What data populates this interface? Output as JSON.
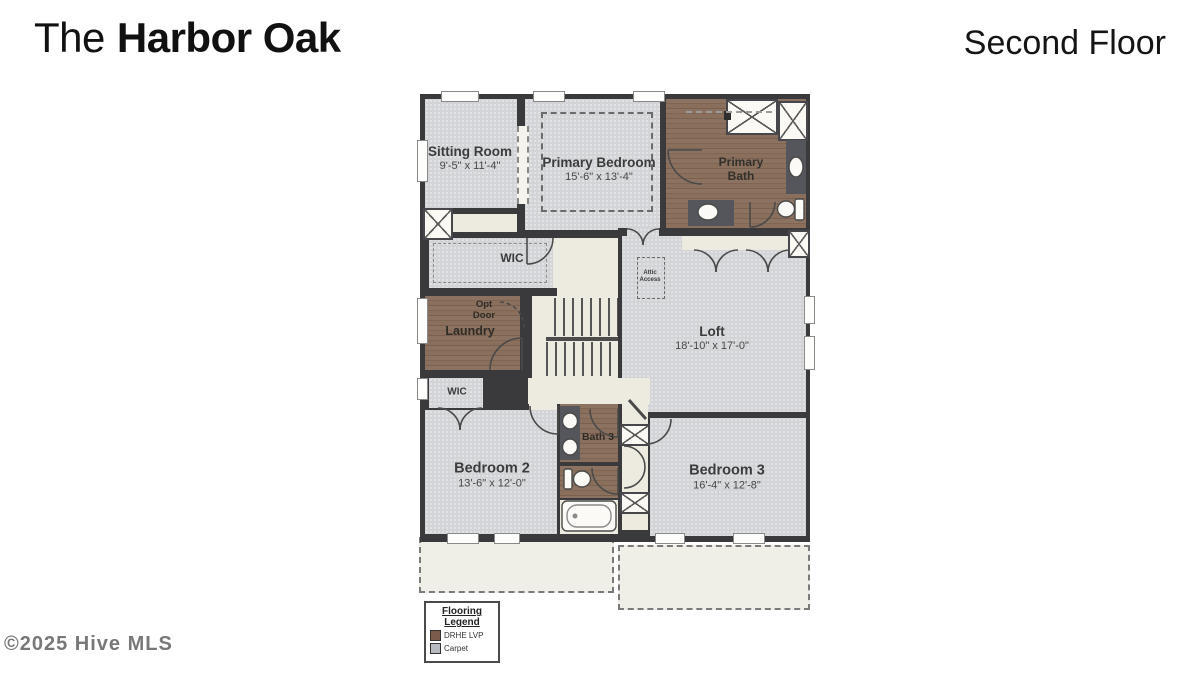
{
  "header": {
    "title_prefix": "The",
    "title_name": "Harbor Oak",
    "floor": "Second Floor"
  },
  "watermark": "©2025 Hive MLS",
  "plan": {
    "rooms": {
      "sitting_room": {
        "label": "Sitting Room",
        "dims": "9'-5\" x 11'-4\""
      },
      "primary_bedroom": {
        "label": "Primary Bedroom",
        "dims": "15'-6\" x 13'-4\""
      },
      "primary_bath": {
        "label": "Primary Bath"
      },
      "wic_primary": {
        "label": "WIC"
      },
      "laundry": {
        "label": "Laundry",
        "opt_door": "Opt Door"
      },
      "attic_access": {
        "label": "Attic Access"
      },
      "loft": {
        "label": "Loft",
        "dims": "18'-10\" x 17'-0\""
      },
      "wic_bedroom2": {
        "label": "WIC"
      },
      "bedroom_2": {
        "label": "Bedroom 2",
        "dims": "13'-6\" x 12'-0\""
      },
      "bath_3": {
        "label": "Bath 3"
      },
      "bedroom_3": {
        "label": "Bedroom 3",
        "dims": "16'-4\" x 12'-8\""
      }
    },
    "fixtures": [
      "shower-icon",
      "corner-shower-icon",
      "sink-icon",
      "toilet-icon",
      "tub-icon",
      "stairs",
      "attic-access-hatch"
    ]
  },
  "legend": {
    "title_line1": "Flooring",
    "title_line2": "Legend",
    "items": [
      {
        "label": "DRHE LVP",
        "swatch_style": "background:#7b5c4a"
      },
      {
        "label": "Carpet",
        "swatch_style": "background:#b7bac1"
      }
    ]
  },
  "colors": {
    "wall": "#3a3a3c",
    "carpet": "#d2d4d7",
    "wood_lvp": "#8c7260",
    "hall": "#edebe0",
    "legend_lvp": "#7b5c4a",
    "legend_carpet": "#b7bac1"
  }
}
